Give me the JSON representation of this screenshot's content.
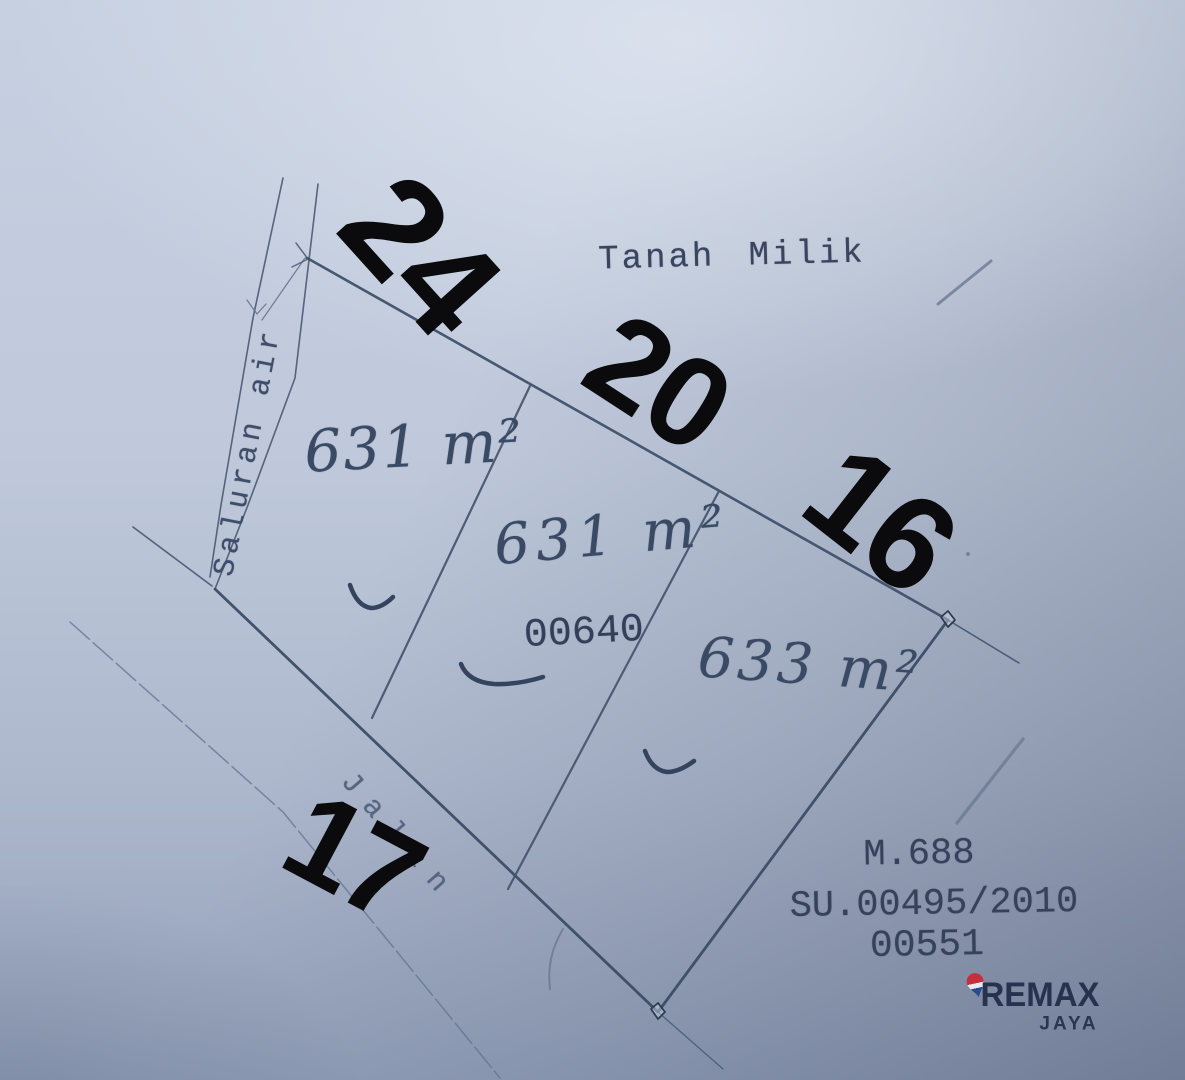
{
  "labels": {
    "land_status": "Tanah Milik",
    "water_channel": "Saluran air",
    "road": "Jalan",
    "parcel_number": "00640"
  },
  "plots": [
    {
      "name": "plot-1",
      "area": "631 m²"
    },
    {
      "name": "plot-2",
      "area": "631 m²"
    },
    {
      "name": "plot-3",
      "area": "633 m²"
    }
  ],
  "dimensions_m": [
    {
      "edge": "top-left",
      "value": "24"
    },
    {
      "edge": "top-middle",
      "value": "20"
    },
    {
      "edge": "top-right",
      "value": "16"
    },
    {
      "edge": "road-frontage",
      "value": "17"
    }
  ],
  "certificate": {
    "line1": "M.688",
    "line2": "SU.00495/2010",
    "line3": "00551"
  },
  "branding": {
    "name": "REMAX",
    "unit": "JAYA",
    "balloon_icon": "remax-balloon-pin"
  },
  "colors": {
    "paper": "#bfc9db",
    "ink": "#44536e",
    "overlay_numbers": "#0b0b0d",
    "remax_navy": "#27334e",
    "balloon_red": "#c6303c",
    "balloon_blue": "#274b8f"
  }
}
